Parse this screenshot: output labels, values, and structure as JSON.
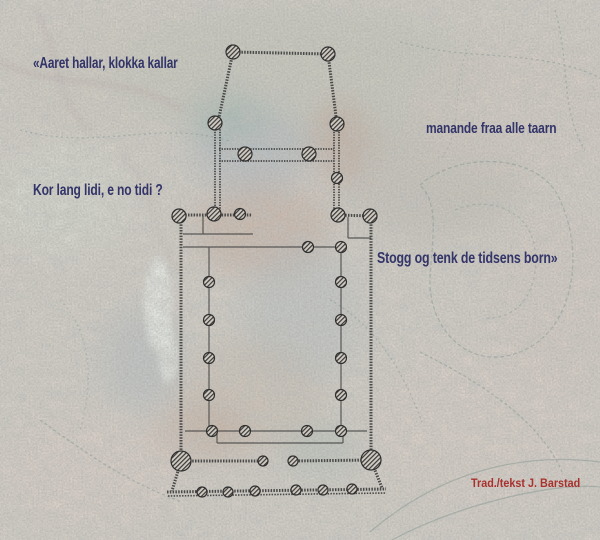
{
  "artwork": {
    "quote": {
      "line1": "«Aaret hallar, klokka kallar",
      "line2": "manande fraa alle taarn",
      "line3": "Kor lang lidi, e no tidi ?",
      "line4": "Stogg og tenk de tidsens born»"
    },
    "credit": "Trad./tekst J. Barstad",
    "colors": {
      "quote_text": "#333569",
      "credit_text": "#a8302d",
      "plan_line": "#3a3a3a",
      "background_base": "#d8d3cb"
    }
  }
}
